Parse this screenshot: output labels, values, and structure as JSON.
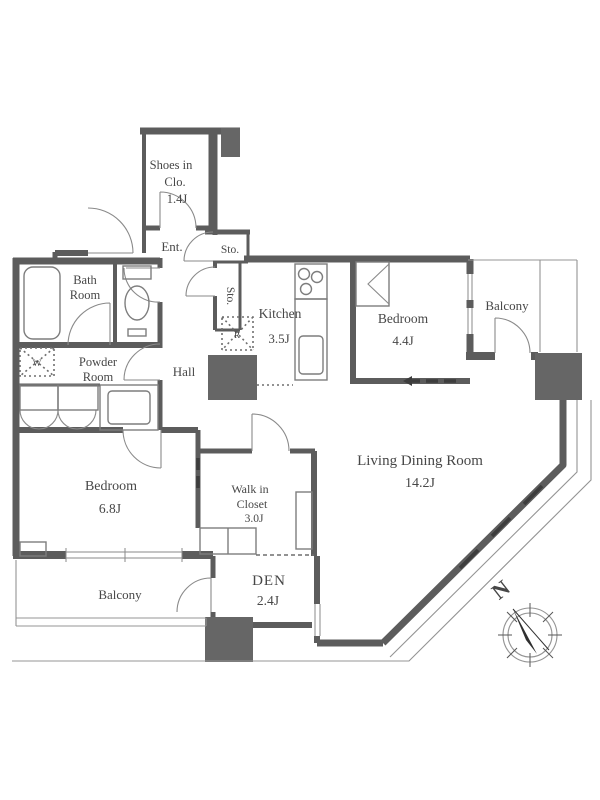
{
  "floorplan": {
    "rooms": {
      "shoes_closet": {
        "name_line1": "Shoes in",
        "name_line2": "Clo.",
        "area": "1.4J"
      },
      "entrance": {
        "name": "Ent."
      },
      "storage_top": {
        "name": "Sto."
      },
      "storage_side": {
        "name": "Sto."
      },
      "bath": {
        "name_line1": "Bath",
        "name_line2": "Room"
      },
      "powder": {
        "name_line1": "Powder",
        "name_line2": "Room"
      },
      "hall": {
        "name": "Hall"
      },
      "kitchen": {
        "name": "Kitchen",
        "area": "3.5J"
      },
      "bedroom_small": {
        "name": "Bedroom",
        "area": "4.4J"
      },
      "balcony_top": {
        "name": "Balcony"
      },
      "living_dining": {
        "name": "Living Dining Room",
        "area": "14.2J"
      },
      "bedroom_main": {
        "name": "Bedroom",
        "area": "6.8J"
      },
      "walk_in_closet": {
        "name_line1": "Walk in",
        "name_line2": "Closet",
        "area": "3.0J"
      },
      "den": {
        "name": "DEN",
        "area": "2.4J"
      },
      "balcony_bottom": {
        "name": "Balcony"
      }
    },
    "fixtures": {
      "washer": "W",
      "fridge": "R"
    },
    "compass": {
      "north": "N"
    },
    "colors": {
      "wall": "#5c5c5c",
      "thin_line": "#949494",
      "text": "#474747",
      "pillar": "#666666"
    }
  }
}
